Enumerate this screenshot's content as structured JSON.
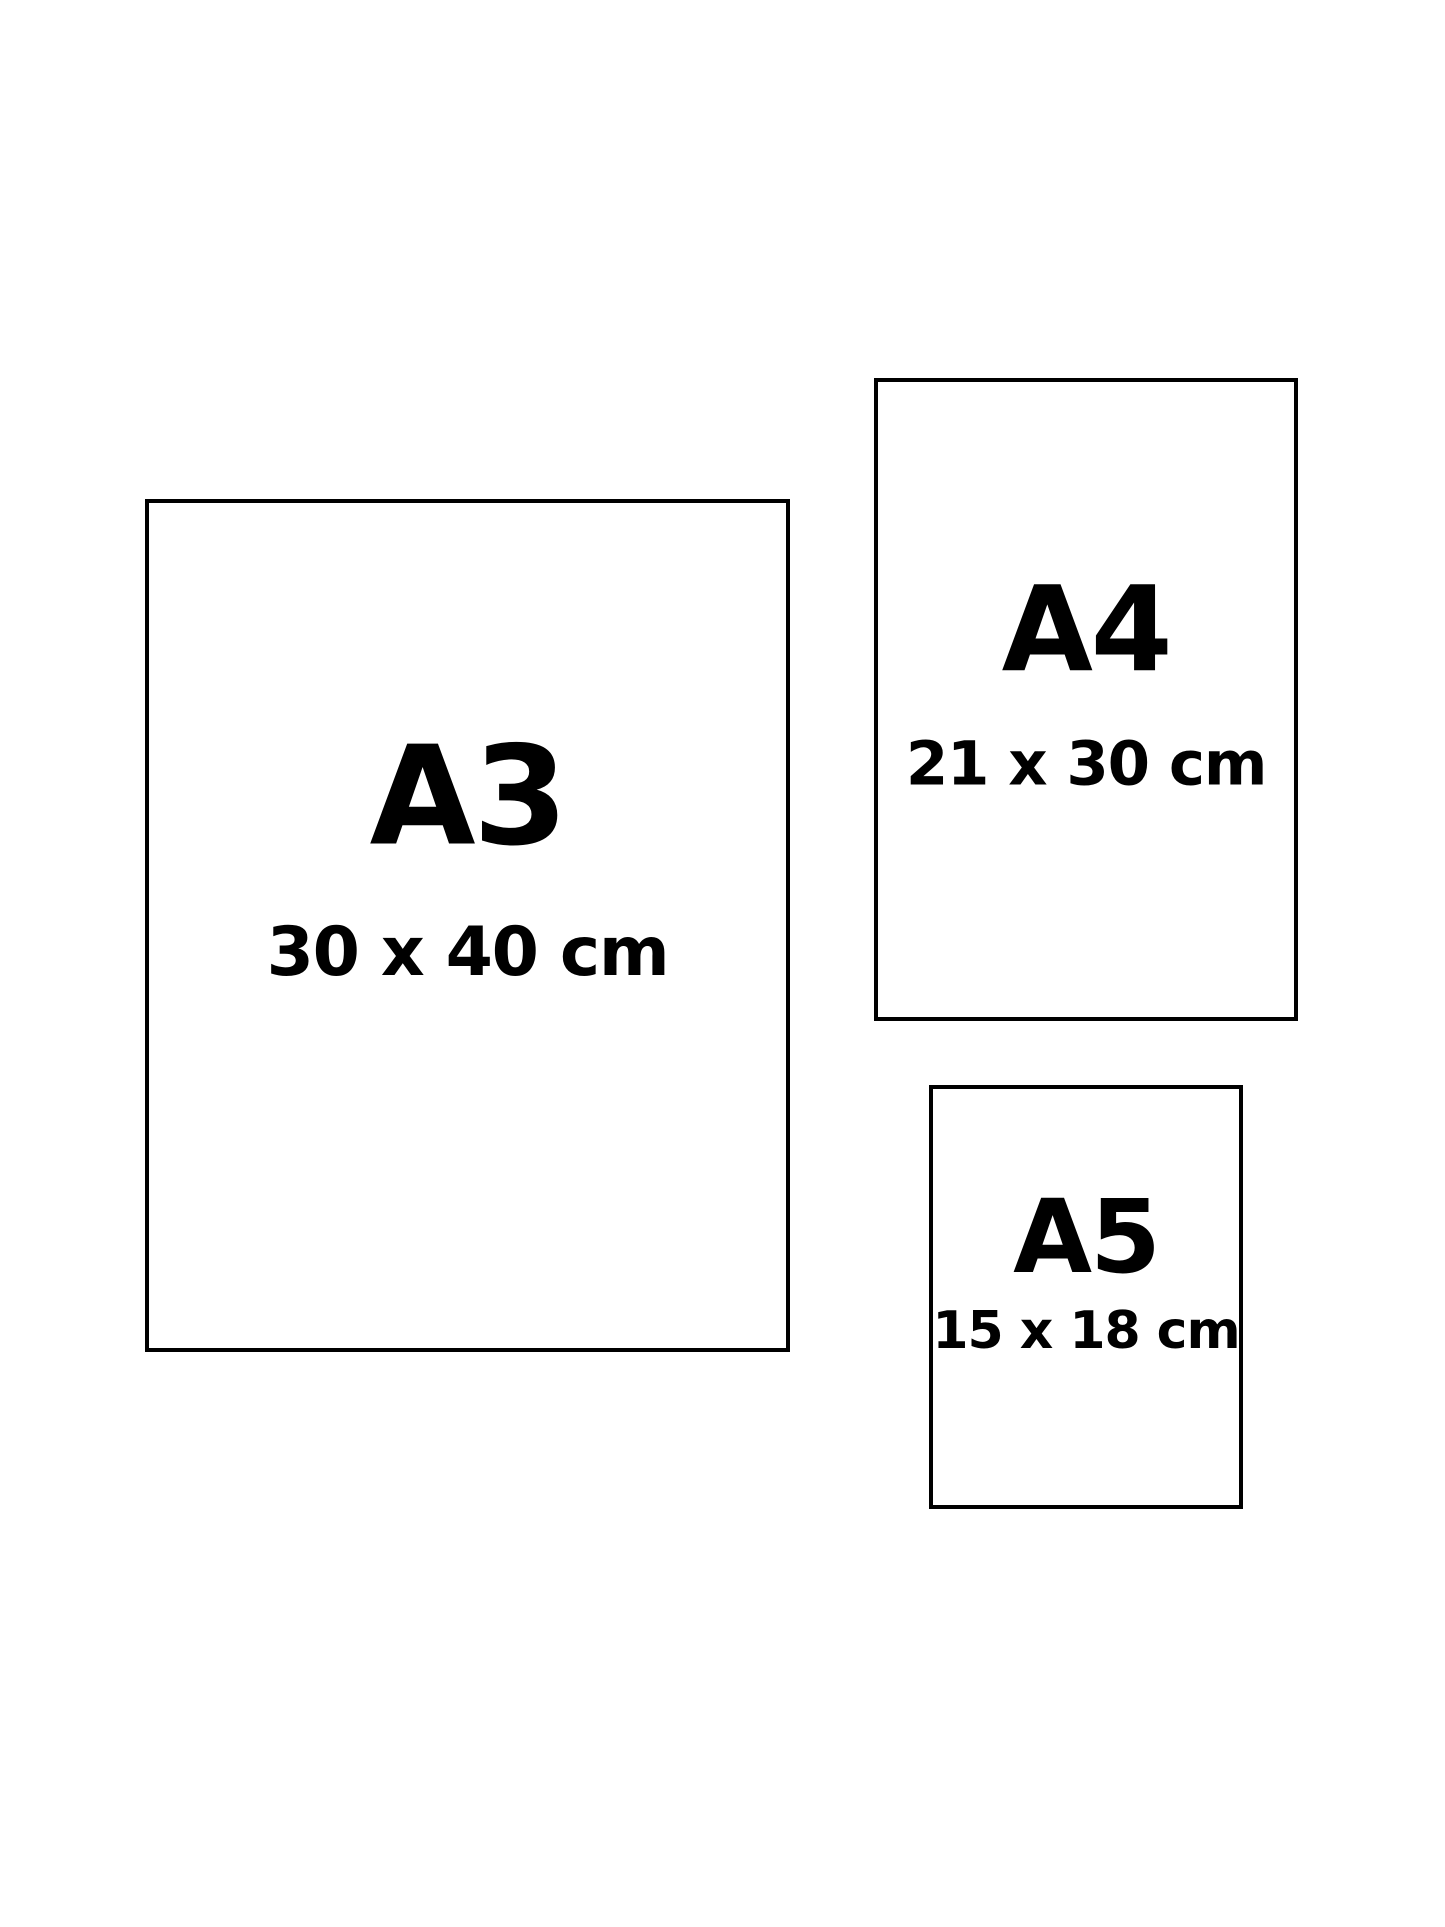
{
  "page": {
    "background_color": "#ffffff",
    "border_color": "#000000",
    "text_color": "#000000"
  },
  "paper_sizes": [
    {
      "label": "A3",
      "dimensions": "30 x 40 cm"
    },
    {
      "label": "A4",
      "dimensions": "21 x 30 cm"
    },
    {
      "label": "A5",
      "dimensions": "15 x 18 cm"
    }
  ]
}
